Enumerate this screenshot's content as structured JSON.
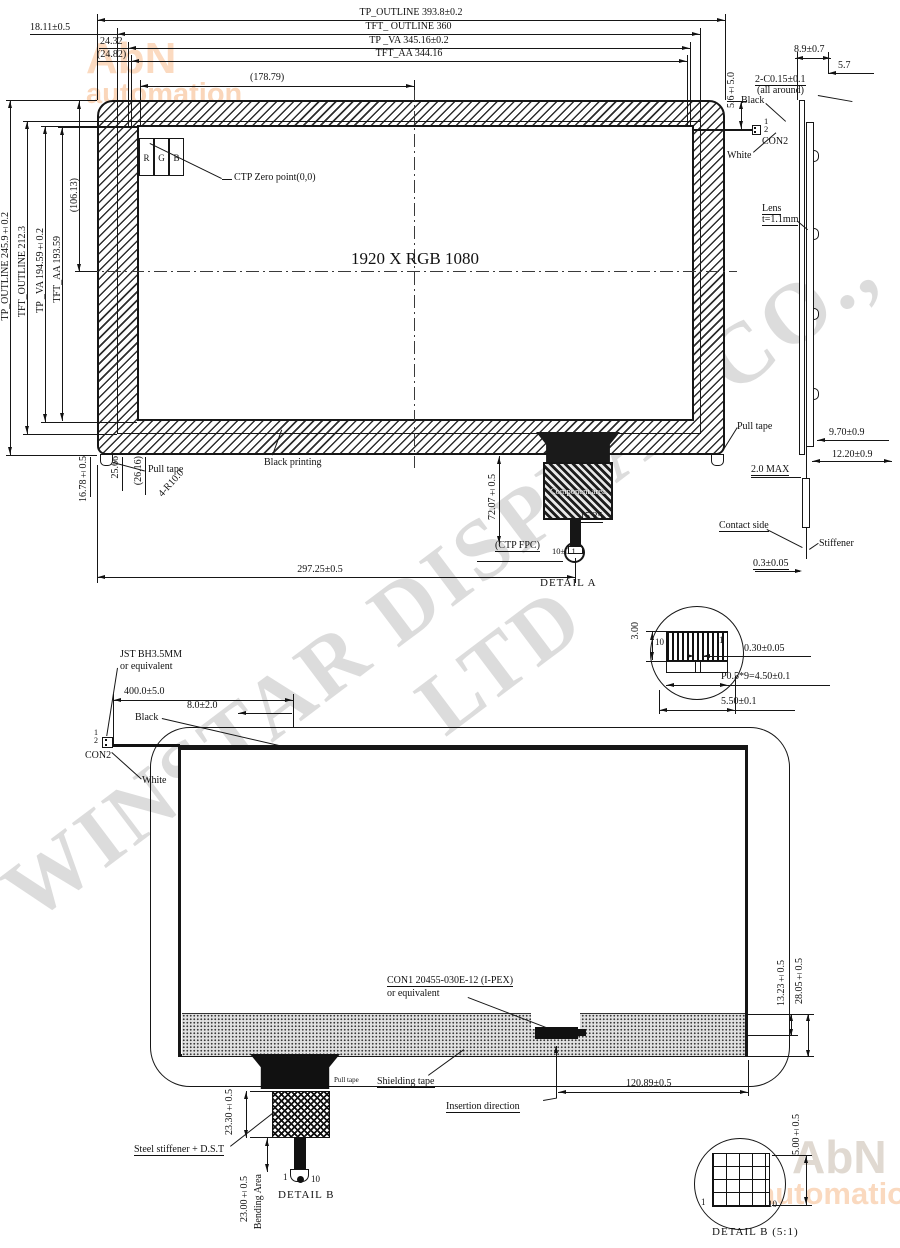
{
  "wm": {
    "diag": "WINSTAR DISPLAY CO., LTD",
    "abn": "AbN",
    "auto": "automation"
  },
  "d1": {
    "dim_tp_outline_w": "TP_OUTLINE 393.8±0.2",
    "dim_left_offset": "18.11±0.5",
    "dim_tft_outline_w": "TFT_ OUTLINE 360",
    "dim_2432": "24.32",
    "dim_tp_va_w": "TP _VA 345.16±0.2",
    "dim_2482": "(24.82)",
    "dim_tft_aa_w": "TFT_AA 344.16",
    "dim_17879": "(178.79)",
    "dim_tp_outline_h": "TP_OUTLINE 245.9±0.2",
    "dim_tft_outline_h": "TFT_OUTLINE 212.3",
    "dim_tp_va_h": "TP _VA 194.59±0.2",
    "dim_tft_aa_h": "TFT_AA 193.59",
    "dim_10613": "(106.13)",
    "dim_1678": "16.78±0.5",
    "dim_2566": "25.66",
    "dim_2616": "(26.16)",
    "dim_r10": "4-R10.0",
    "res": "1920 X RGB 1080",
    "r": "R",
    "g": "G",
    "b": "B",
    "ctp_zero": "CTP Zero point(0,0)",
    "black_printing": "Black printing",
    "pull_tape": "Pull tape",
    "pull_tape_r": "Pull tape",
    "dim_bottom": "297.25±0.5",
    "dim_fpc_v": "72.07±0.5",
    "dim_1525": "15.25",
    "ctp_fpc": "(CTP FPC)",
    "dim_10": "10±0.1",
    "detail_a": "DETAIL A",
    "comp_area": "Component area",
    "chamfer": "2-C0.15±0.1",
    "chamfer2": "(all around)",
    "dim_56": "5.6±5.0",
    "black": "Black",
    "white": "White",
    "p1": "1",
    "p2": "2",
    "con2": "CON2",
    "dim_89": "8.9±0.7",
    "dim_57": "5.7",
    "lens": "Lens",
    "lens_t": "t=1.1mm",
    "dim_970": "9.70±0.9",
    "dim_1220": "12.20±0.9",
    "dim_20max": "2.0 MAX",
    "contact": "Contact side",
    "stiffener": "Stiffener",
    "dim_03": "0.3±0.05"
  },
  "da": {
    "dim_300": "3.00",
    "p10": "10",
    "p1": "1",
    "dim_030": "0.30±0.05",
    "dim_p05": "P0.5*9=4.50±0.1",
    "dim_550": "5.50±0.1"
  },
  "d2": {
    "jst": "JST BH3.5MM",
    "jst2": "or equivalent",
    "dim_400": "400.0±5.0",
    "dim_80": "8.0±2.0",
    "black": "Black",
    "white": "White",
    "p1": "1",
    "p2": "2",
    "con2": "CON2",
    "con1": "CON1    20455-030E-12 (I-PEX)",
    "con1b": "or equivalent",
    "shield": "Shielding tape",
    "insert": "Insertion direction",
    "dim_12089": "120.89±0.5",
    "dim_1323": "13.23±0.5",
    "dim_2805": "28.05±0.5",
    "pull": "Pull tape",
    "steel": "Steel stiffener + D.S.T",
    "dim_2330": "23.30±0.5",
    "dim_2300": "23.00±0.5",
    "bend": "Bending Area",
    "p1b": "1",
    "p10": "10",
    "detail_b": "DETAIL B"
  },
  "db": {
    "dim_500": "5.00±0.5",
    "p1": "1",
    "p10": "10",
    "caption": "DETAIL B (5:1)"
  }
}
